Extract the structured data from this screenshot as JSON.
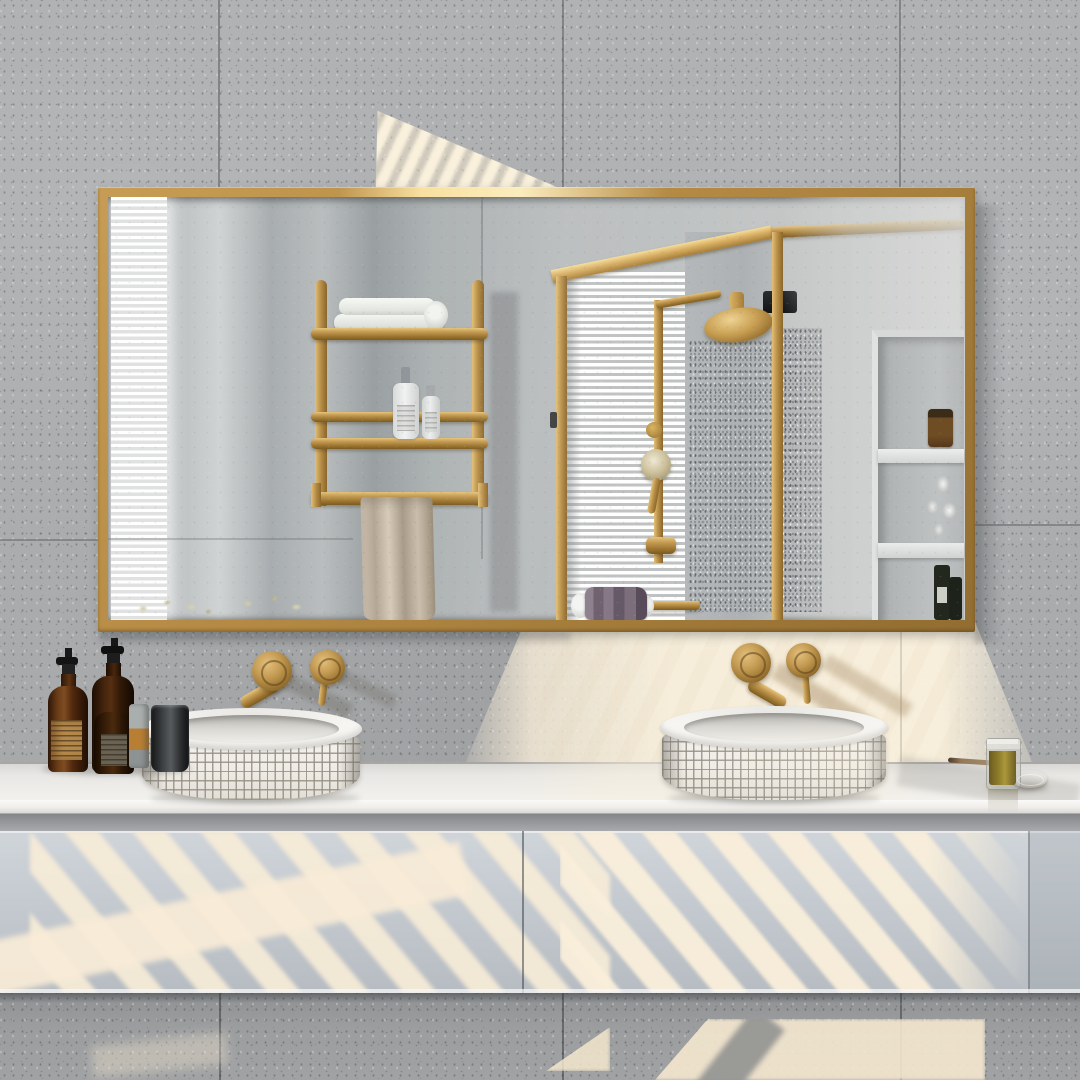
{
  "scene": {
    "description": "Photograph of a modern bathroom: wide gold-framed mirror on a speckled concrete wall reflecting a glass shower enclosure, window blinds and a gold towel shelf; below, a floating gray vanity with two round white mosaic vessel sinks, wall-mounted gold faucets, amber soap bottles, and a small candle jar; diagonal sunlight stripes fall across the walls and cabinet.",
    "visible_text": [],
    "palette": {
      "wall": "#adafb1",
      "wall_lower": "#97999b",
      "gold": "#b68c44",
      "gold_bright": "#e8c878",
      "gold_dark": "#8a6830",
      "mirror_glass": "#bcbfc0",
      "sunlight": "#f6ead0",
      "counter": "#f2f1ee",
      "cabinet": "#c6ccd2",
      "ceramic": "#f3f1ec",
      "amber_glass": "#5a3013",
      "label_tan": "#b98d4e",
      "towel_purple": "#6e5f6d",
      "towel_beige": "#c3b5a3",
      "candle_wax": "#8f7c2e",
      "lid_silver": "#aeb0b2",
      "blinds_white": "#f3f4f4"
    },
    "objects": {
      "mirror": "rectangular gold-framed wall mirror",
      "reflection": [
        "window blind light strip",
        "gold towel shelf with white towels, two lotion bottles and hanging beige towel",
        "gold shower column with rain head and hand shower",
        "glass shower enclosure with gold frame",
        "wall niche with candle, dried flowers and dark bottles",
        "towel bar with purple towel"
      ],
      "fixtures": [
        "left wall-mounted gold faucet with lever",
        "right wall-mounted gold faucet with lever"
      ],
      "counter_items": [
        "two amber pump bottles",
        "small amber bottle",
        "gray tube",
        "dark tumbler",
        "olive candle jar",
        "silver lid",
        "wooden stick"
      ],
      "furniture": [
        "white stone countertop",
        "two round mosaic vessel sinks",
        "floating gray vanity cabinet"
      ]
    }
  }
}
